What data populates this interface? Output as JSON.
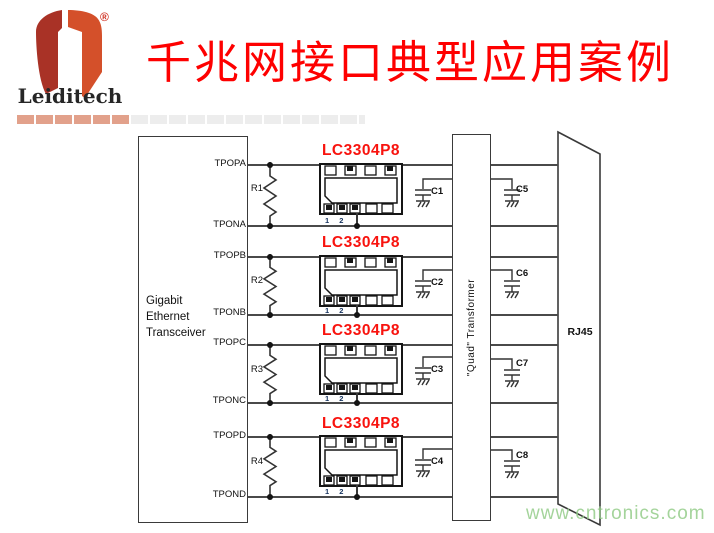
{
  "header": {
    "brand": "Leiditech",
    "registered_mark": "®",
    "title": "千兆网接口典型应用案例"
  },
  "diagram": {
    "transceiver_label": [
      "Gigabit",
      "Ethernet",
      "Transceiver"
    ],
    "transformer_label": "\"Quad\" Transformer",
    "rj45_label": "RJ45",
    "channels": [
      {
        "top_pin": "TPOPA",
        "bottom_pin": "TPONA",
        "resistor": "R1",
        "chip_label": "LC3304P8",
        "left_cap": "C1",
        "right_cap": "C5",
        "pin_numbers": "1 2"
      },
      {
        "top_pin": "TPOPB",
        "bottom_pin": "TPONB",
        "resistor": "R2",
        "chip_label": "LC3304P8",
        "left_cap": "C2",
        "right_cap": "C6",
        "pin_numbers": "1 2"
      },
      {
        "top_pin": "TPOPC",
        "bottom_pin": "TPONC",
        "resistor": "R3",
        "chip_label": "LC3304P8",
        "left_cap": "C3",
        "right_cap": "C7",
        "pin_numbers": "1 2"
      },
      {
        "top_pin": "TPOPD",
        "bottom_pin": "TPOND",
        "resistor": "R4",
        "chip_label": "LC3304P8",
        "left_cap": "C4",
        "right_cap": "C8",
        "pin_numbers": "1 2"
      }
    ]
  },
  "watermark": "www.cntronics.com",
  "colors": {
    "title_red": "#fe0000",
    "chip_label_red": "#f8130e",
    "logo_dark_red": "#a93226",
    "logo_orange": "#d4502a",
    "bar_salmon": "#e2a18b",
    "bar_gray": "#ededed",
    "line_gray": "#4a4a4a",
    "watermark_green": "#94cd8a"
  }
}
